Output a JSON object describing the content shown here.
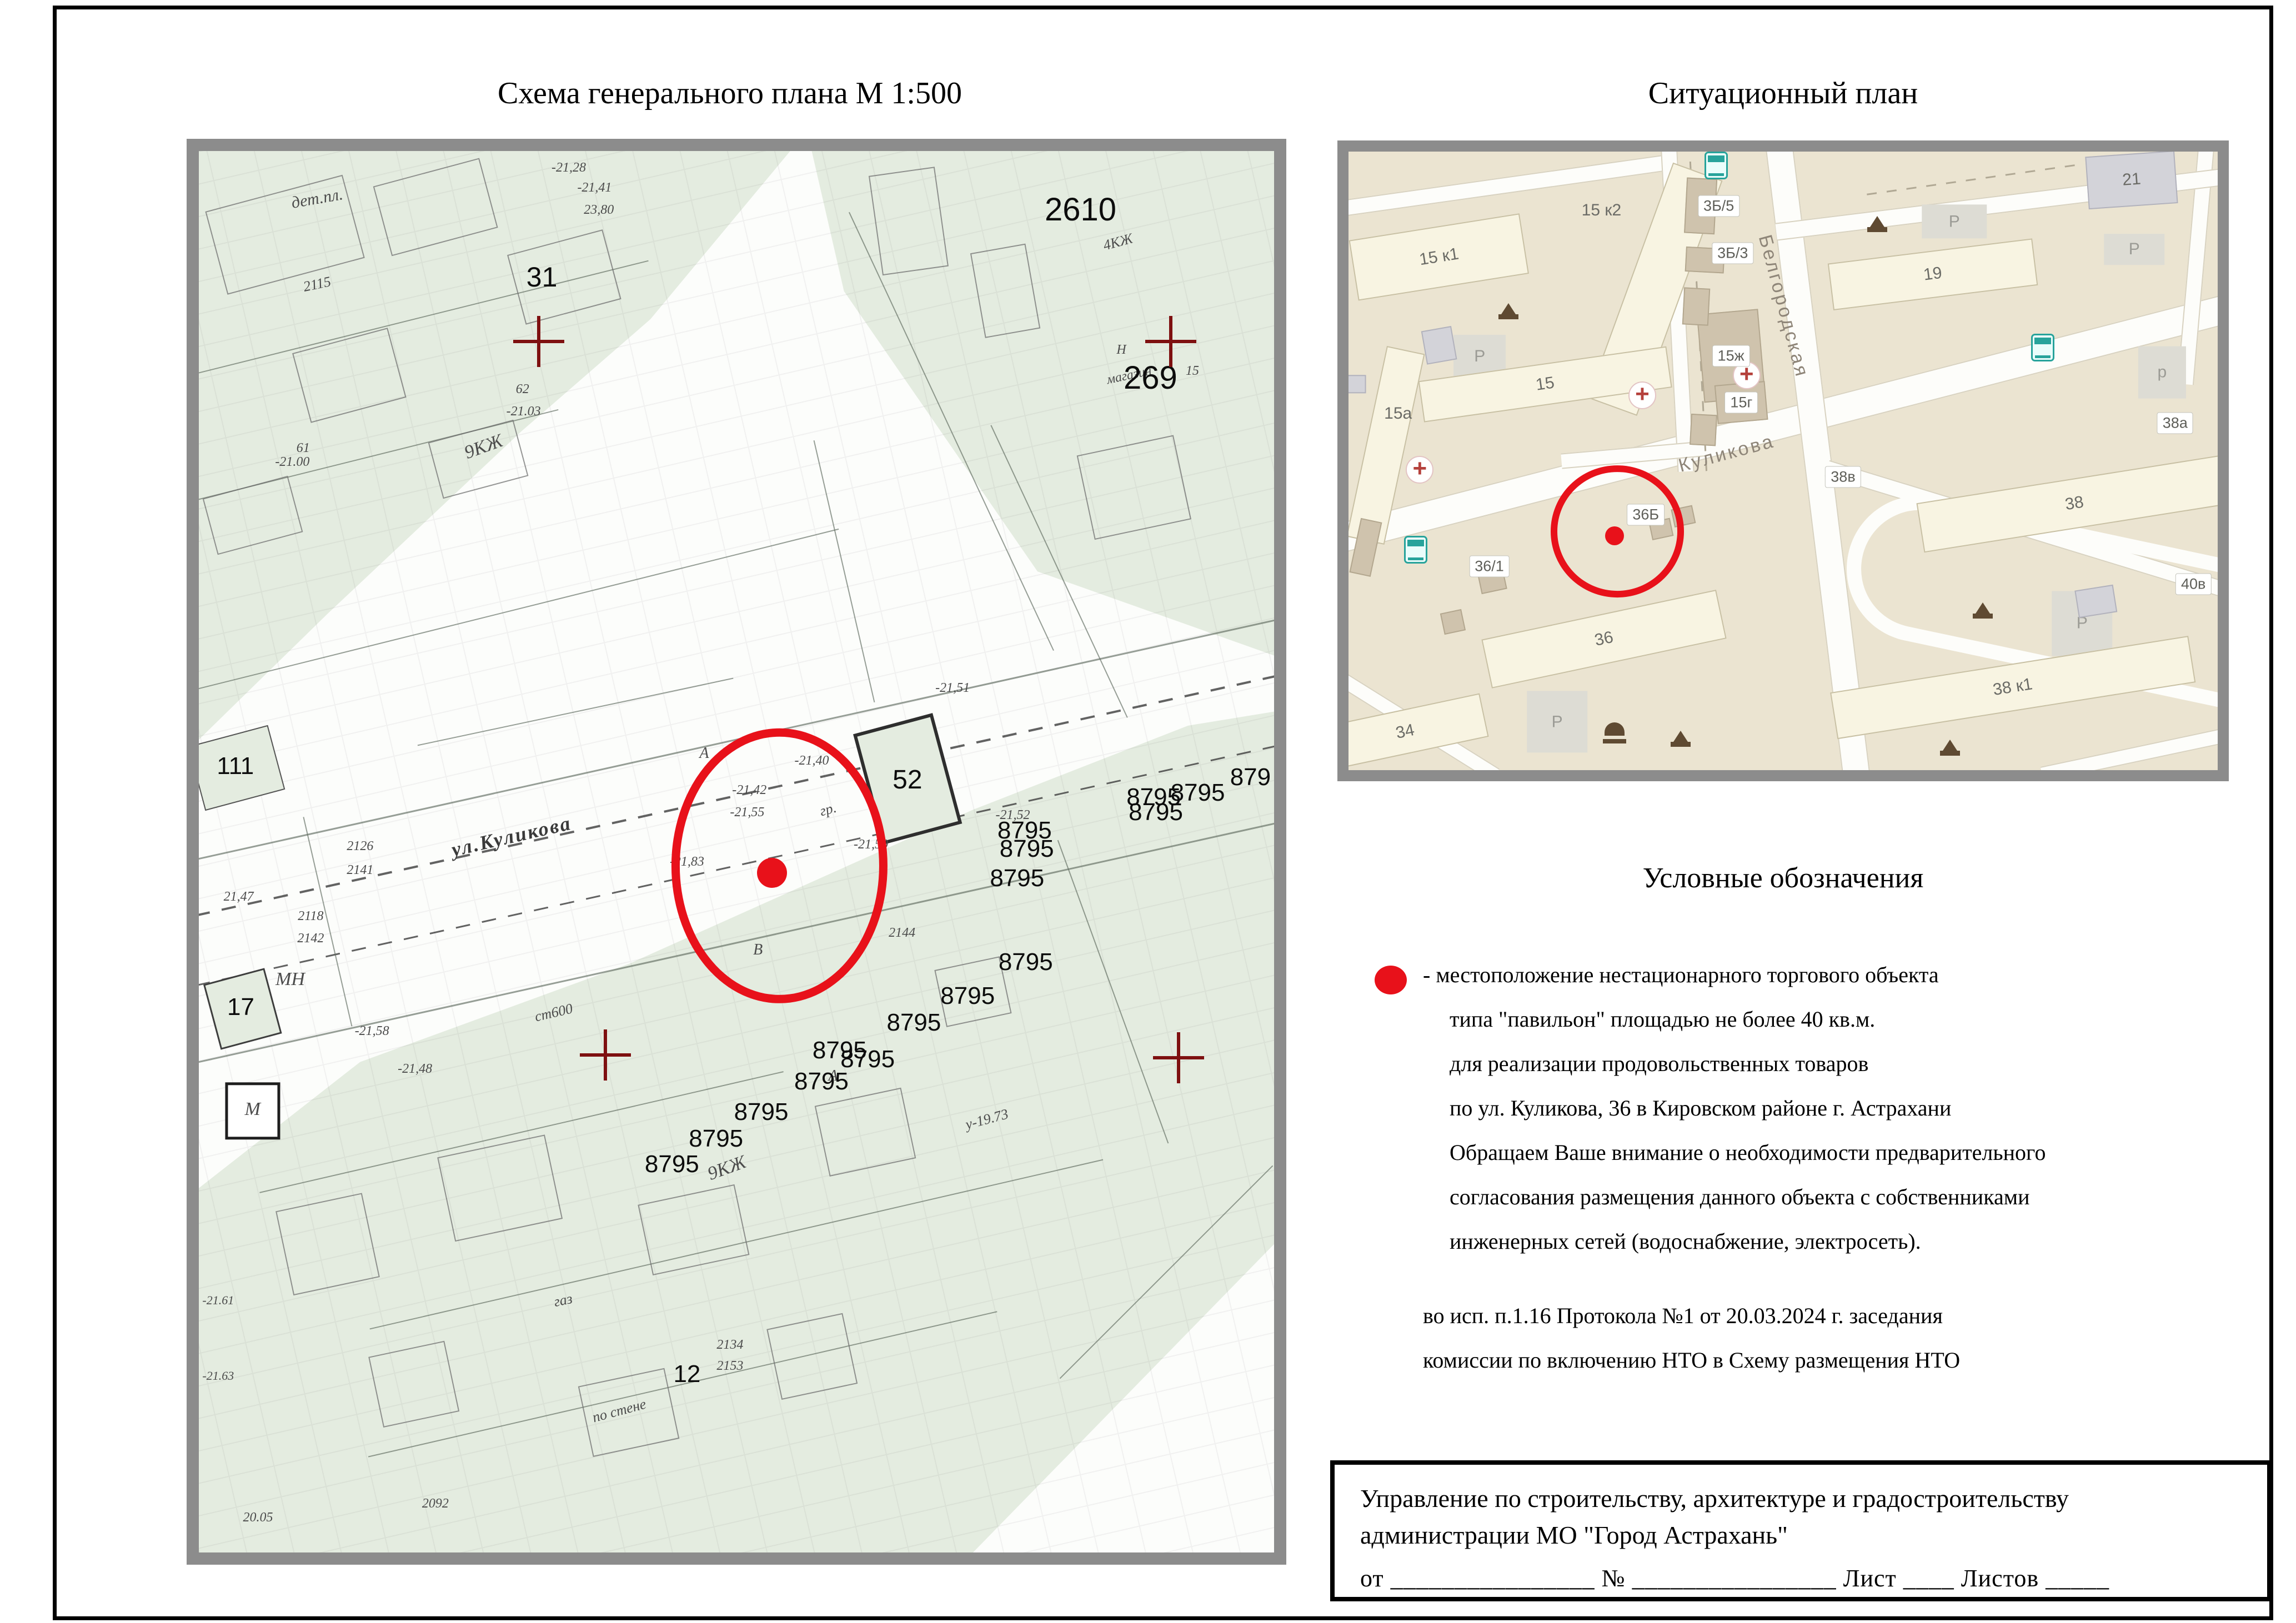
{
  "colors": {
    "red": "#e8111a",
    "dark_red": "#7e1010",
    "frame_gray": "#8c8c8c",
    "genplan_green": "#e4ece0",
    "sitplan_bg": "#ebe4d1",
    "building_cream": "#f8f4e2",
    "road_white": "#fdfdfa",
    "icon_brown": "#5f4a32",
    "bus_teal": "#27a39b"
  },
  "page": {
    "title_left": "Схема генерального плана М 1:500",
    "title_right": "Ситуационный план",
    "legend": {
      "heading": "Условные обозначения",
      "lines": [
        "- местоположение нестационарного торгового объекта",
        "типа \"павильон\" площадью не более 40 кв.м.",
        "для реализации продовольственных товаров",
        "по ул. Куликова, 36 в Кировском районе г. Астрахани",
        "Обращаем Ваше внимание о необходимости предварительного",
        "согласования размещения данного объекта с собственниками",
        "инженерных сетей (водоснабжение, электросеть)."
      ]
    },
    "note_lines": [
      "во исп. п.1.16 Протокола №1 от 20.03.2024 г. заседания",
      "комиссии по включению НТО в Схему размещения НТО"
    ],
    "stamp": {
      "org_line1": "Управление по строительству, архитектуре и градостроительству",
      "org_line2": "администрации МО \"Город Астрахань\"",
      "fields_line": "от ________________  № ________________  Лист ____  Листов _____"
    }
  },
  "genplan": {
    "big_labels": [
      {
        "t": "31",
        "x": 31.9,
        "y": 9.0,
        "s": 50
      },
      {
        "t": "2610",
        "x": 82.0,
        "y": 4.2,
        "s": 58
      },
      {
        "t": "269",
        "x": 88.5,
        "y": 16.2,
        "s": 58
      },
      {
        "t": "111",
        "x": 3.4,
        "y": 43.9,
        "s": 44
      },
      {
        "t": "17",
        "x": 3.9,
        "y": 61.1,
        "s": 44
      },
      {
        "t": "52",
        "x": 65.9,
        "y": 44.9,
        "s": 48
      },
      {
        "t": "12",
        "x": 45.4,
        "y": 87.3,
        "s": 44
      },
      {
        "t": "8795",
        "x": 88.8,
        "y": 46.1,
        "s": 44
      },
      {
        "t": "8795",
        "x": 92.9,
        "y": 45.8,
        "s": 44
      },
      {
        "t": "8795",
        "x": 89.0,
        "y": 47.2,
        "s": 44
      },
      {
        "t": "879",
        "x": 97.8,
        "y": 44.7,
        "s": 44
      },
      {
        "t": "8795",
        "x": 76.8,
        "y": 48.5,
        "s": 44
      },
      {
        "t": "8795",
        "x": 77.0,
        "y": 49.8,
        "s": 44
      },
      {
        "t": "8795",
        "x": 76.1,
        "y": 51.9,
        "s": 44
      },
      {
        "t": "8795",
        "x": 76.9,
        "y": 57.9,
        "s": 44
      },
      {
        "t": "8795",
        "x": 71.5,
        "y": 60.3,
        "s": 44
      },
      {
        "t": "8795",
        "x": 66.5,
        "y": 62.2,
        "s": 44
      },
      {
        "t": "8795",
        "x": 62.2,
        "y": 64.8,
        "s": 44
      },
      {
        "t": "8795",
        "x": 59.6,
        "y": 64.2,
        "s": 44
      },
      {
        "t": "8795",
        "x": 57.9,
        "y": 66.4,
        "s": 44
      },
      {
        "t": "8795",
        "x": 52.3,
        "y": 68.6,
        "s": 44
      },
      {
        "t": "8795",
        "x": 48.1,
        "y": 70.5,
        "s": 44
      },
      {
        "t": "8795",
        "x": 44.0,
        "y": 72.3,
        "s": 44
      }
    ],
    "decor_labels": [
      {
        "t": "дет.пл.",
        "x": 11.0,
        "y": 3.4,
        "r": -10,
        "s": 30
      },
      {
        "t": "9КЖ",
        "x": 26.5,
        "y": 21.1,
        "r": -20,
        "s": 34
      },
      {
        "t": "9КЖ",
        "x": 49.1,
        "y": 72.6,
        "r": -20,
        "s": 34
      },
      {
        "t": "ул.Куликова",
        "x": 29.1,
        "y": 48.9,
        "r": -13,
        "s": 36,
        "k": "street"
      },
      {
        "t": "-21,42",
        "x": 51.2,
        "y": 45.6,
        "s": 24
      },
      {
        "t": "-21,55",
        "x": 51.0,
        "y": 47.2,
        "s": 24
      },
      {
        "t": "-21,50",
        "x": 62.5,
        "y": 49.5,
        "s": 24
      },
      {
        "t": "-21,83",
        "x": 45.4,
        "y": 50.7,
        "s": 24
      },
      {
        "t": "2144",
        "x": 65.4,
        "y": 55.8,
        "s": 24
      },
      {
        "t": "-21,51",
        "x": 70.1,
        "y": 38.3,
        "s": 24
      },
      {
        "t": "-21,52",
        "x": 75.7,
        "y": 47.4,
        "s": 24
      },
      {
        "t": "2126",
        "x": 15.0,
        "y": 49.6,
        "s": 24
      },
      {
        "t": "2141",
        "x": 15.0,
        "y": 51.3,
        "s": 24
      },
      {
        "t": "21,47",
        "x": 3.7,
        "y": 53.2,
        "s": 24
      },
      {
        "t": "2118",
        "x": 10.4,
        "y": 54.6,
        "s": 24
      },
      {
        "t": "2142",
        "x": 10.4,
        "y": 56.2,
        "s": 24
      },
      {
        "t": "МН",
        "x": 8.5,
        "y": 59.1,
        "s": 34
      },
      {
        "t": "М",
        "x": 5.0,
        "y": 68.4,
        "s": 34
      },
      {
        "t": "-21,58",
        "x": 16.1,
        "y": 62.8,
        "s": 24
      },
      {
        "t": "-21,48",
        "x": 20.1,
        "y": 65.5,
        "s": 24
      },
      {
        "t": "ст600",
        "x": 33.0,
        "y": 61.5,
        "r": -13,
        "s": 26
      },
      {
        "t": "по стене",
        "x": 39.1,
        "y": 89.9,
        "r": -15,
        "s": 26
      },
      {
        "t": "газ",
        "x": 33.9,
        "y": 82.0,
        "r": -12,
        "s": 26
      },
      {
        "t": "у-19.73",
        "x": 73.3,
        "y": 69.1,
        "r": -15,
        "s": 26
      },
      {
        "t": "-21.61",
        "x": 1.8,
        "y": 82.0,
        "s": 22
      },
      {
        "t": "-21.63",
        "x": 1.8,
        "y": 87.4,
        "s": 22
      },
      {
        "t": "62",
        "x": 30.1,
        "y": 17.0,
        "s": 24
      },
      {
        "t": "-21.03",
        "x": 30.2,
        "y": 18.6,
        "s": 24
      },
      {
        "t": "61",
        "x": 9.7,
        "y": 21.2,
        "s": 24
      },
      {
        "t": "-21.00",
        "x": 8.7,
        "y": 22.2,
        "s": 24
      },
      {
        "t": "-21,28",
        "x": 34.4,
        "y": 1.2,
        "s": 24
      },
      {
        "t": "-21,41",
        "x": 36.8,
        "y": 2.6,
        "s": 24
      },
      {
        "t": "23,80",
        "x": 37.2,
        "y": 4.2,
        "s": 24
      },
      {
        "t": "4КЖ",
        "x": 85.5,
        "y": 6.5,
        "r": -15,
        "s": 26
      },
      {
        "t": "Н",
        "x": 85.8,
        "y": 14.2,
        "s": 24
      },
      {
        "t": "магазин",
        "x": 86.5,
        "y": 16.0,
        "r": -12,
        "s": 24
      },
      {
        "t": "15",
        "x": 92.4,
        "y": 15.7,
        "s": 24
      },
      {
        "t": "2134",
        "x": 49.4,
        "y": 85.2,
        "s": 24
      },
      {
        "t": "2153",
        "x": 49.4,
        "y": 86.7,
        "s": 24
      },
      {
        "t": "20.05",
        "x": 5.5,
        "y": 97.5,
        "s": 24
      },
      {
        "t": "2092",
        "x": 22.0,
        "y": 96.5,
        "s": 24
      },
      {
        "t": "А",
        "x": 47.0,
        "y": 43.0,
        "s": 28
      },
      {
        "t": "В",
        "x": 52.0,
        "y": 57.0,
        "s": 28
      },
      {
        "t": "А",
        "x": 59.0,
        "y": 66.0,
        "s": 28
      },
      {
        "t": "гр.",
        "x": 58.5,
        "y": 47.0,
        "r": -15,
        "s": 26
      },
      {
        "t": "-21,40",
        "x": 57.0,
        "y": 43.5,
        "s": 24
      },
      {
        "t": "2115",
        "x": 11.0,
        "y": 9.5,
        "r": -12,
        "s": 26
      }
    ],
    "crosses": [
      {
        "x": 31.6,
        "y": 13.6
      },
      {
        "x": 90.4,
        "y": 13.6
      },
      {
        "x": 37.8,
        "y": 64.5
      },
      {
        "x": 91.1,
        "y": 64.7
      }
    ],
    "lines": [
      {
        "x": 50,
        "y": 46,
        "l": 108,
        "r": -12.5,
        "wp": 4,
        "k": "dash"
      },
      {
        "x": 50,
        "y": 51,
        "l": 108,
        "r": -12.5,
        "wp": 3,
        "k": "dash"
      },
      {
        "x": 50,
        "y": 42,
        "l": 108,
        "r": -12.5,
        "wp": 3
      },
      {
        "x": 50,
        "y": 56.5,
        "l": 108,
        "r": -12.5,
        "wp": 3
      },
      {
        "x": 28,
        "y": 33,
        "l": 65,
        "r": -14,
        "wp": 2
      },
      {
        "x": 20,
        "y": 12,
        "l": 45,
        "r": -14,
        "wp": 2
      },
      {
        "x": 15,
        "y": 22,
        "l": 38,
        "r": -14,
        "wp": 2
      },
      {
        "x": 70,
        "y": 20,
        "l": 45,
        "r": 65,
        "wp": 2
      },
      {
        "x": 80,
        "y": 30,
        "l": 30,
        "r": 65,
        "wp": 2
      },
      {
        "x": 30,
        "y": 70,
        "l": 50,
        "r": -13,
        "wp": 2
      },
      {
        "x": 50,
        "y": 78,
        "l": 70,
        "r": -13,
        "wp": 2
      },
      {
        "x": 45,
        "y": 88,
        "l": 60,
        "r": -13,
        "wp": 2
      },
      {
        "x": 85,
        "y": 60,
        "l": 30,
        "r": 70,
        "wp": 2
      },
      {
        "x": 90,
        "y": 80,
        "l": 28,
        "r": -45,
        "wp": 2
      },
      {
        "x": 12,
        "y": 55,
        "l": 20,
        "r": 77,
        "wp": 2
      },
      {
        "x": 60,
        "y": 30,
        "l": 25,
        "r": 77,
        "wp": 2
      },
      {
        "x": 35,
        "y": 40,
        "l": 30,
        "r": -12,
        "wp": 2
      }
    ],
    "outlines": [
      {
        "x": 8,
        "y": 6,
        "w": 13,
        "h": 6,
        "r": -15
      },
      {
        "x": 22,
        "y": 4,
        "w": 10,
        "h": 5,
        "r": -15
      },
      {
        "x": 34,
        "y": 9,
        "w": 9,
        "h": 5,
        "r": -15
      },
      {
        "x": 14,
        "y": 16,
        "w": 9,
        "h": 5,
        "r": -15
      },
      {
        "x": 5,
        "y": 26,
        "w": 8,
        "h": 4,
        "r": -15
      },
      {
        "x": 26,
        "y": 22,
        "w": 8,
        "h": 4,
        "r": -15
      },
      {
        "x": 66,
        "y": 5,
        "w": 6,
        "h": 7,
        "r": -8
      },
      {
        "x": 75,
        "y": 10,
        "w": 5,
        "h": 6,
        "r": -10
      },
      {
        "x": 87,
        "y": 24,
        "w": 9,
        "h": 6,
        "r": -12
      },
      {
        "x": 12,
        "y": 78,
        "w": 8,
        "h": 6,
        "r": -12
      },
      {
        "x": 28,
        "y": 74,
        "w": 10,
        "h": 6,
        "r": -12
      },
      {
        "x": 46,
        "y": 77,
        "w": 9,
        "h": 5,
        "r": -12
      },
      {
        "x": 62,
        "y": 70,
        "w": 8,
        "h": 5,
        "r": -12
      },
      {
        "x": 20,
        "y": 88,
        "w": 7,
        "h": 5,
        "r": -12
      },
      {
        "x": 40,
        "y": 90,
        "w": 8,
        "h": 5,
        "r": -12
      },
      {
        "x": 57,
        "y": 86,
        "w": 7,
        "h": 5,
        "r": -12
      },
      {
        "x": 72,
        "y": 60,
        "w": 6,
        "h": 4,
        "r": -12
      }
    ]
  },
  "sitplan": {
    "roads": [
      {
        "x": 50,
        "y": 44,
        "l": 115,
        "r": -14.5,
        "wp": 50
      },
      {
        "x": 54,
        "y": 50,
        "l": 75,
        "r": 83,
        "wp": 46
      },
      {
        "x": 18,
        "y": 5.5,
        "l": 40,
        "r": -8,
        "wp": 26
      },
      {
        "x": 37.8,
        "y": 25,
        "l": 38,
        "r": 87,
        "wp": 26
      },
      {
        "x": 33,
        "y": 49,
        "l": 17,
        "r": -5,
        "wp": 24
      },
      {
        "x": 97.5,
        "y": 18,
        "l": 28,
        "r": 95,
        "wp": 26
      },
      {
        "x": 78,
        "y": 61,
        "l": 48,
        "r": 17,
        "wp": 26
      },
      {
        "x": 8,
        "y": 93,
        "l": 21,
        "r": 32,
        "wp": 24
      },
      {
        "x": 75,
        "y": 8.5,
        "l": 52,
        "r": -7,
        "wp": 28
      },
      {
        "x": 92,
        "y": 97,
        "l": 25,
        "r": -12,
        "wp": 24
      },
      {
        "x": 40.2,
        "y": 25,
        "l": 38,
        "r": 87,
        "wp": 3,
        "k": "dash"
      },
      {
        "x": 72,
        "y": 4.5,
        "l": 25,
        "r": -8,
        "wp": 3,
        "k": "dash"
      }
    ],
    "buildings": [
      {
        "t": "15 к1",
        "x": 10.4,
        "y": 17.1,
        "w": 19.9,
        "h": 9.9,
        "r": -9,
        "k": "cream"
      },
      {
        "t": "",
        "x": 35.3,
        "y": 22.3,
        "w": 6.1,
        "h": 40.5,
        "r": 20,
        "k": "cream"
      },
      {
        "t": "15",
        "x": 22.6,
        "y": 37.6,
        "w": 28.8,
        "h": 6.7,
        "r": -8,
        "k": "cream"
      },
      {
        "t": "",
        "x": 4.3,
        "y": 47.5,
        "w": 4.5,
        "h": 31.5,
        "r": 12,
        "k": "cream"
      },
      {
        "t": "36",
        "x": 29.4,
        "y": 78.8,
        "w": 27.6,
        "h": 8.1,
        "r": -12,
        "k": "cream"
      },
      {
        "t": "34",
        "x": 6.5,
        "y": 93.8,
        "w": 18.6,
        "h": 7.2,
        "r": -12,
        "k": "cream"
      },
      {
        "t": "19",
        "x": 67.2,
        "y": 19.8,
        "w": 23.7,
        "h": 7.6,
        "r": -7,
        "k": "cream"
      },
      {
        "t": "38",
        "x": 83.5,
        "y": 56.9,
        "w": 35.9,
        "h": 8.1,
        "r": -9,
        "k": "cream"
      },
      {
        "t": "38 к1",
        "x": 76.4,
        "y": 86.6,
        "w": 41.7,
        "h": 7.6,
        "r": -9,
        "k": "cream"
      },
      {
        "t": "21",
        "x": 90.1,
        "y": 4.6,
        "w": 10.3,
        "h": 8.5,
        "r": -4,
        "k": "grayb"
      },
      {
        "t": "",
        "x": 10.4,
        "y": 31.3,
        "w": 3.5,
        "h": 5.5,
        "r": -10,
        "k": "grayb"
      },
      {
        "t": "",
        "x": 86.0,
        "y": 72.7,
        "w": 4.5,
        "h": 4.5,
        "r": -9,
        "k": "grayb"
      },
      {
        "t": "",
        "x": 0.5,
        "y": 37.6,
        "w": 3,
        "h": 3,
        "r": 0,
        "k": "grayb"
      },
      {
        "t": "",
        "x": 44.0,
        "y": 33.0,
        "w": 7.1,
        "h": 14.4,
        "r": -5,
        "k": "shed"
      },
      {
        "t": "",
        "x": 45.2,
        "y": 40.6,
        "w": 5.8,
        "h": 6.3,
        "r": -5,
        "k": "shed"
      },
      {
        "t": "",
        "x": 40.5,
        "y": 8.8,
        "w": 3.5,
        "h": 9,
        "r": 3,
        "k": "shed"
      },
      {
        "t": "",
        "x": 41.0,
        "y": 17.5,
        "w": 4.5,
        "h": 4,
        "r": 3,
        "k": "shed"
      },
      {
        "t": "",
        "x": 40.0,
        "y": 25,
        "w": 3,
        "h": 6,
        "r": 3,
        "k": "shed"
      },
      {
        "t": "",
        "x": 40.8,
        "y": 45,
        "w": 3,
        "h": 5,
        "r": 3,
        "k": "shed"
      },
      {
        "t": "",
        "x": 36.0,
        "y": 61,
        "w": 2.5,
        "h": 3,
        "r": -12,
        "k": "shed"
      },
      {
        "t": "",
        "x": 38.5,
        "y": 59,
        "w": 2.5,
        "h": 3,
        "r": -12,
        "k": "shed"
      },
      {
        "t": "",
        "x": 16.5,
        "y": 69.1,
        "w": 3,
        "h": 4,
        "r": -12,
        "k": "shed"
      },
      {
        "t": "",
        "x": 12,
        "y": 76,
        "w": 2.5,
        "h": 3.5,
        "r": -12,
        "k": "shed"
      },
      {
        "t": "",
        "x": 2,
        "y": 64,
        "w": 2.5,
        "h": 9,
        "r": 12,
        "k": "shed"
      }
    ],
    "pills": [
      {
        "t": "3Б/5",
        "x": 42.6,
        "y": 8.8
      },
      {
        "t": "3Б/3",
        "x": 44.2,
        "y": 16.4
      },
      {
        "t": "15ж",
        "x": 44.0,
        "y": 33.0
      },
      {
        "t": "15г",
        "x": 45.2,
        "y": 40.6
      },
      {
        "t": "36Б",
        "x": 34.2,
        "y": 58.7
      },
      {
        "t": "36/1",
        "x": 16.2,
        "y": 67.1
      },
      {
        "t": "38в",
        "x": 56.9,
        "y": 52.6
      },
      {
        "t": "38а",
        "x": 95.1,
        "y": 43.9
      },
      {
        "t": "40в",
        "x": 97.2,
        "y": 69.9
      }
    ],
    "labels": [
      {
        "t": "15 к2",
        "x": 29.1,
        "y": 9.5,
        "s": 30
      },
      {
        "t": "15а",
        "x": 5.7,
        "y": 42.4,
        "s": 30
      },
      {
        "t": "Куликова",
        "x": 43.5,
        "y": 48.8,
        "r": -15,
        "s": 34,
        "k": "street"
      },
      {
        "t": "Белгородская",
        "x": 50.0,
        "y": 25.0,
        "r": 75,
        "s": 34,
        "k": "street"
      }
    ],
    "parks": [
      {
        "t": "Р",
        "x": 15.1,
        "y": 33.1,
        "w": 6,
        "h": 7
      },
      {
        "t": "Р",
        "x": 69.7,
        "y": 11.3,
        "w": 7.5,
        "h": 5.5
      },
      {
        "t": "Р",
        "x": 90.4,
        "y": 15.8,
        "w": 7,
        "h": 5
      },
      {
        "t": "p",
        "x": 93.6,
        "y": 35.7,
        "w": 5.5,
        "h": 8.5
      },
      {
        "t": "Р",
        "x": 24.0,
        "y": 92.2,
        "w": 7,
        "h": 10
      },
      {
        "t": "Р",
        "x": 84.4,
        "y": 76.3,
        "w": 7,
        "h": 10.5
      }
    ],
    "icons": [
      {
        "k": "play",
        "x": 18.4,
        "y": 25.4
      },
      {
        "k": "play",
        "x": 60.8,
        "y": 11.3
      },
      {
        "k": "play",
        "x": 73.0,
        "y": 73.8
      },
      {
        "k": "play",
        "x": 69.2,
        "y": 96.0
      },
      {
        "k": "play",
        "x": 38.2,
        "y": 94.5
      },
      {
        "k": "bench",
        "x": 30.6,
        "y": 94.2
      },
      {
        "k": "bus",
        "x": 42.3,
        "y": 2.2
      },
      {
        "k": "bus",
        "x": 7.7,
        "y": 64.4
      },
      {
        "k": "bus",
        "x": 79.9,
        "y": 31.7
      },
      {
        "k": "cross",
        "x": 33.8,
        "y": 39.4
      },
      {
        "k": "cross",
        "x": 45.8,
        "y": 36.2
      },
      {
        "k": "cross",
        "x": 8.2,
        "y": 51.4
      }
    ]
  }
}
